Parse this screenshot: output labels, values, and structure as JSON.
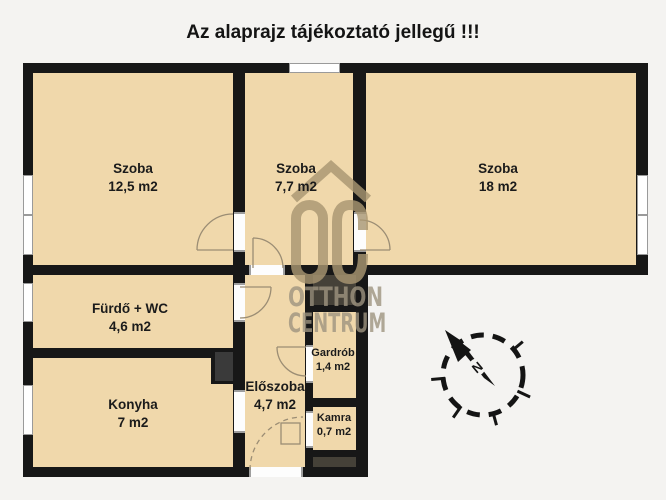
{
  "title": "Az alaprajz tájékoztató jellegű !!!",
  "rooms": [
    {
      "name": "Szoba",
      "area": "12,5 m2"
    },
    {
      "name": "Szoba",
      "area": "7,7 m2"
    },
    {
      "name": "Szoba",
      "area": "18 m2"
    },
    {
      "name": "Fürdő + WC",
      "area": "4,6 m2"
    },
    {
      "name": "Konyha",
      "area": "7 m2"
    },
    {
      "name": "Előszoba",
      "area": "4,7 m2"
    },
    {
      "name": "Gardrób",
      "area": "1,4 m2"
    },
    {
      "name": "Kamra",
      "area": "0,7 m2"
    }
  ],
  "watermark": {
    "logo": "OC",
    "name_line1": "OTTHON",
    "name_line2": "CENTRUM"
  },
  "compass": {
    "north_label": "N"
  },
  "colors": {
    "background": "#f4f3f1",
    "room_fill": "#f0d8ab",
    "wall": "#171717",
    "shaft": "#454138",
    "watermark": "#a69570",
    "door_arc": "#9b8d74"
  }
}
